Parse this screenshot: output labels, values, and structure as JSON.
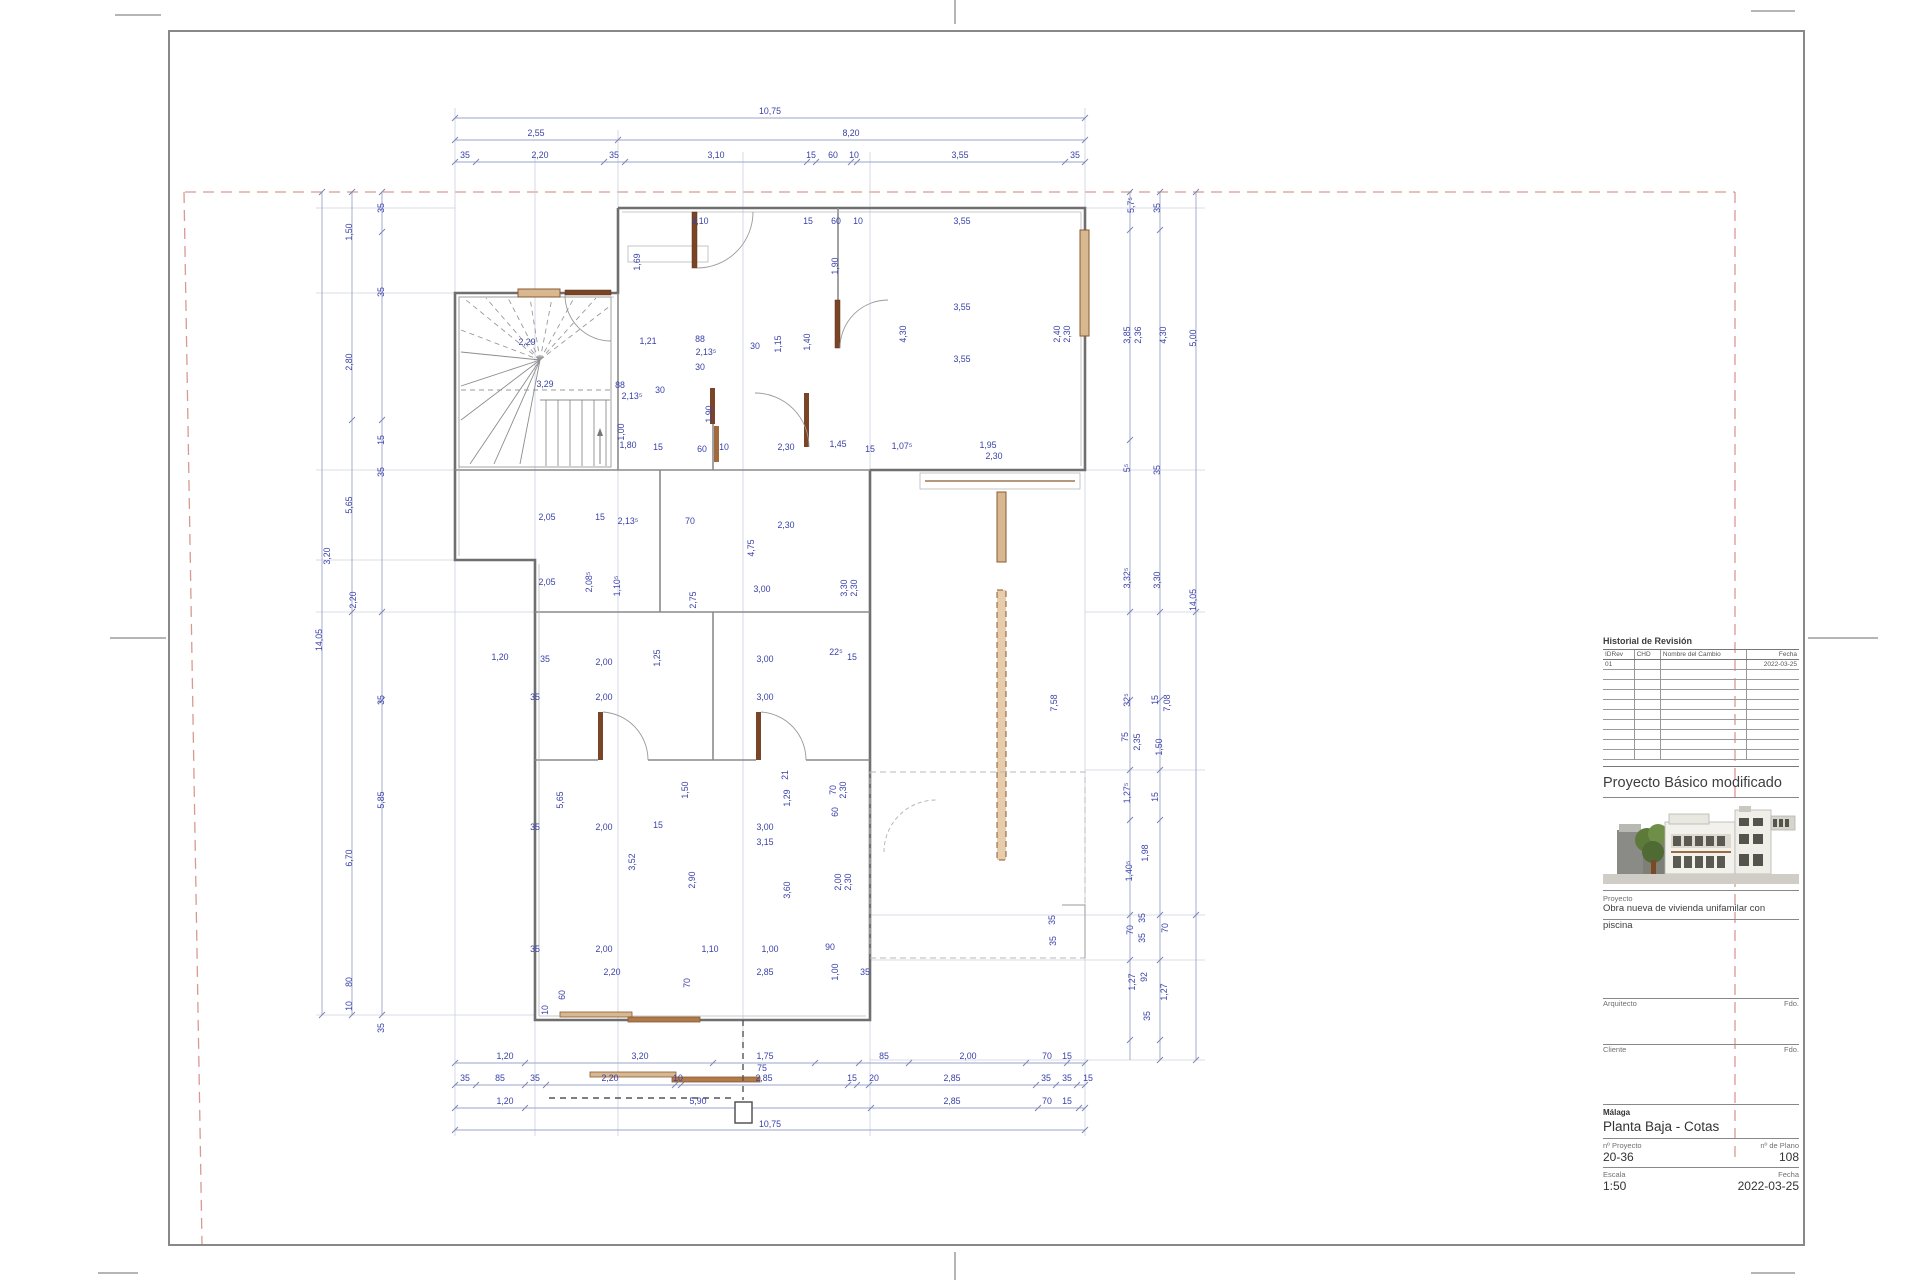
{
  "title_block": {
    "revision": {
      "title": "Historial de Revisión",
      "columns": [
        "IDRev",
        "CHD",
        "Nombre del Cambio",
        "Fecha"
      ],
      "rows": [
        [
          "01",
          "",
          "",
          "2022-03-25"
        ]
      ],
      "empty_row_count": 9
    },
    "project_title": "Proyecto Básico modificado",
    "proyecto_label": "Proyecto",
    "proyecto_line1": "Obra nueva de vivienda unifamilar con",
    "proyecto_line2": "piscina",
    "arquitecto_label": "Arquitecto",
    "cliente_label": "Cliente",
    "fdo_label": "Fdo.",
    "city": "Málaga",
    "sheet_name": "Planta Baja - Cotas",
    "num_proyecto_label": "nº Proyecto",
    "num_plano_label": "nº de Plano",
    "num_proyecto": "20-36",
    "num_plano": "108",
    "escala_label": "Escala",
    "fecha_label": "Fecha",
    "escala": "1:50",
    "fecha": "2022-03-25"
  },
  "colors": {
    "dim_text": "#3a41a8",
    "dim_line": "#9aa3c9",
    "wall": "#6f6f6f",
    "door_wood": "#8a5a32",
    "door_wood_fill": "#d8b890",
    "boundary_red": "#d89a90"
  },
  "drawing": {
    "dims": [
      {
        "x": 770,
        "y": 114,
        "t": "10,75"
      },
      {
        "x": 536,
        "y": 136,
        "t": "2,55"
      },
      {
        "x": 851,
        "y": 136,
        "t": "8,20"
      },
      {
        "x": 465,
        "y": 158,
        "t": "35"
      },
      {
        "x": 540,
        "y": 158,
        "t": "2,20"
      },
      {
        "x": 614,
        "y": 158,
        "t": "35"
      },
      {
        "x": 716,
        "y": 158,
        "t": "3,10"
      },
      {
        "x": 811,
        "y": 158,
        "t": "15"
      },
      {
        "x": 833,
        "y": 158,
        "t": "60"
      },
      {
        "x": 854,
        "y": 158,
        "t": "10"
      },
      {
        "x": 960,
        "y": 158,
        "t": "3,55"
      },
      {
        "x": 1075,
        "y": 158,
        "t": "35"
      },
      {
        "x": 505,
        "y": 1059,
        "t": "1,20"
      },
      {
        "x": 640,
        "y": 1059,
        "t": "3,20"
      },
      {
        "x": 765,
        "y": 1059,
        "t": "1,75"
      },
      {
        "x": 762,
        "y": 1071,
        "t": "75"
      },
      {
        "x": 884,
        "y": 1059,
        "t": "85"
      },
      {
        "x": 968,
        "y": 1059,
        "t": "2,00"
      },
      {
        "x": 1047,
        "y": 1059,
        "t": "70"
      },
      {
        "x": 1067,
        "y": 1059,
        "t": "15"
      },
      {
        "x": 465,
        "y": 1081,
        "t": "35"
      },
      {
        "x": 500,
        "y": 1081,
        "t": "85"
      },
      {
        "x": 535,
        "y": 1081,
        "t": "35"
      },
      {
        "x": 610,
        "y": 1081,
        "t": "2,20"
      },
      {
        "x": 678,
        "y": 1081,
        "t": "10"
      },
      {
        "x": 764,
        "y": 1081,
        "t": "2,85"
      },
      {
        "x": 852,
        "y": 1081,
        "t": "15"
      },
      {
        "x": 874,
        "y": 1081,
        "t": "20"
      },
      {
        "x": 952,
        "y": 1081,
        "t": "2,85"
      },
      {
        "x": 1046,
        "y": 1081,
        "t": "35"
      },
      {
        "x": 1067,
        "y": 1081,
        "t": "35"
      },
      {
        "x": 1088,
        "y": 1081,
        "t": "15"
      },
      {
        "x": 505,
        "y": 1104,
        "t": "1,20"
      },
      {
        "x": 698,
        "y": 1104,
        "t": "5,90"
      },
      {
        "x": 952,
        "y": 1104,
        "t": "2,85"
      },
      {
        "x": 1047,
        "y": 1104,
        "t": "70"
      },
      {
        "x": 1067,
        "y": 1104,
        "t": "15"
      },
      {
        "x": 770,
        "y": 1127,
        "t": "10,75"
      },
      {
        "x": 322,
        "y": 640,
        "t": "14,05",
        "r": "v"
      },
      {
        "x": 352,
        "y": 858,
        "t": "6,70",
        "r": "v"
      },
      {
        "x": 352,
        "y": 232,
        "t": "1,50",
        "r": "v"
      },
      {
        "x": 352,
        "y": 362,
        "t": "2,80",
        "r": "v"
      },
      {
        "x": 352,
        "y": 505,
        "t": "5,65",
        "r": "v"
      },
      {
        "x": 330,
        "y": 556,
        "t": "3,20",
        "r": "v"
      },
      {
        "x": 356,
        "y": 600,
        "t": "2,20",
        "r": "v"
      },
      {
        "x": 352,
        "y": 982,
        "t": "80",
        "r": "v"
      },
      {
        "x": 352,
        "y": 1006,
        "t": "10",
        "r": "v"
      },
      {
        "x": 384,
        "y": 208,
        "t": "35",
        "r": "v"
      },
      {
        "x": 384,
        "y": 292,
        "t": "35",
        "r": "v"
      },
      {
        "x": 384,
        "y": 440,
        "t": "15",
        "r": "v"
      },
      {
        "x": 384,
        "y": 472,
        "t": "35",
        "r": "v"
      },
      {
        "x": 384,
        "y": 700,
        "t": "35",
        "r": "v"
      },
      {
        "x": 384,
        "y": 800,
        "t": "5,85",
        "r": "v"
      },
      {
        "x": 384,
        "y": 1028,
        "t": "35",
        "r": "v"
      },
      {
        "x": 1134,
        "y": 205,
        "t": "5,7⁵",
        "r": "v"
      },
      {
        "x": 1160,
        "y": 208,
        "t": "35",
        "r": "v"
      },
      {
        "x": 1130,
        "y": 335,
        "t": "3,85",
        "r": "v"
      },
      {
        "x": 1141,
        "y": 335,
        "t": "2,36",
        "r": "v"
      },
      {
        "x": 1166,
        "y": 335,
        "t": "4,30",
        "r": "v"
      },
      {
        "x": 1196,
        "y": 338,
        "t": "5,00",
        "r": "v"
      },
      {
        "x": 1130,
        "y": 468,
        "t": "5⁵",
        "r": "v"
      },
      {
        "x": 1160,
        "y": 470,
        "t": "35",
        "r": "v"
      },
      {
        "x": 1130,
        "y": 578,
        "t": "3,32⁵",
        "r": "v"
      },
      {
        "x": 1160,
        "y": 580,
        "t": "3,30",
        "r": "v"
      },
      {
        "x": 1196,
        "y": 600,
        "t": "14,05",
        "r": "v"
      },
      {
        "x": 1130,
        "y": 700,
        "t": "32⁵",
        "r": "v"
      },
      {
        "x": 1158,
        "y": 700,
        "t": "15",
        "r": "v"
      },
      {
        "x": 1128,
        "y": 737,
        "t": "75",
        "r": "v"
      },
      {
        "x": 1140,
        "y": 742,
        "t": "2,35",
        "r": "v"
      },
      {
        "x": 1162,
        "y": 747,
        "t": "1,50",
        "r": "v"
      },
      {
        "x": 1130,
        "y": 793,
        "t": "1,27⁵",
        "r": "v"
      },
      {
        "x": 1158,
        "y": 797,
        "t": "15",
        "r": "v"
      },
      {
        "x": 1132,
        "y": 871,
        "t": "1,40⁵",
        "r": "v"
      },
      {
        "x": 1148,
        "y": 853,
        "t": "1,98",
        "r": "v"
      },
      {
        "x": 1133,
        "y": 930,
        "t": "70",
        "r": "v"
      },
      {
        "x": 1145,
        "y": 918,
        "t": "35",
        "r": "v"
      },
      {
        "x": 1145,
        "y": 938,
        "t": "35",
        "r": "v"
      },
      {
        "x": 1168,
        "y": 928,
        "t": "70",
        "r": "v"
      },
      {
        "x": 1135,
        "y": 982,
        "t": "1,27",
        "r": "v"
      },
      {
        "x": 1147,
        "y": 977,
        "t": "92",
        "r": "v"
      },
      {
        "x": 1167,
        "y": 992,
        "t": "1,27",
        "r": "v"
      },
      {
        "x": 1150,
        "y": 1016,
        "t": "35",
        "r": "v"
      },
      {
        "x": 1170,
        "y": 703,
        "t": "7,08",
        "r": "v"
      },
      {
        "x": 1057,
        "y": 703,
        "t": "7,58",
        "r": "v"
      },
      {
        "x": 1055,
        "y": 920,
        "t": "35",
        "r": "v"
      },
      {
        "x": 1056,
        "y": 941,
        "t": "35",
        "r": "v"
      },
      {
        "x": 700,
        "y": 224,
        "t": "3,10"
      },
      {
        "x": 808,
        "y": 224,
        "t": "15"
      },
      {
        "x": 836,
        "y": 224,
        "t": "60"
      },
      {
        "x": 858,
        "y": 224,
        "t": "10"
      },
      {
        "x": 962,
        "y": 224,
        "t": "3,55"
      },
      {
        "x": 640,
        "y": 262,
        "t": "1,69",
        "r": "v"
      },
      {
        "x": 838,
        "y": 266,
        "t": "1,90",
        "r": "v"
      },
      {
        "x": 962,
        "y": 310,
        "t": "3,55"
      },
      {
        "x": 906,
        "y": 334,
        "t": "4,30",
        "r": "v"
      },
      {
        "x": 1060,
        "y": 334,
        "t": "2,40",
        "r": "v"
      },
      {
        "x": 1070,
        "y": 334,
        "t": "2,30",
        "r": "v"
      },
      {
        "x": 962,
        "y": 362,
        "t": "3,55"
      },
      {
        "x": 648,
        "y": 344,
        "t": "1,21"
      },
      {
        "x": 700,
        "y": 342,
        "t": "88"
      },
      {
        "x": 706,
        "y": 355,
        "t": "2,13⁵"
      },
      {
        "x": 755,
        "y": 349,
        "t": "30"
      },
      {
        "x": 781,
        "y": 344,
        "t": "1,15",
        "r": "v"
      },
      {
        "x": 810,
        "y": 342,
        "t": "1,40",
        "r": "v"
      },
      {
        "x": 527,
        "y": 345,
        "t": "2,29"
      },
      {
        "x": 545,
        "y": 387,
        "t": "3,29"
      },
      {
        "x": 620,
        "y": 388,
        "t": "88"
      },
      {
        "x": 632,
        "y": 399,
        "t": "2,13⁵"
      },
      {
        "x": 660,
        "y": 393,
        "t": "30"
      },
      {
        "x": 700,
        "y": 370,
        "t": "30"
      },
      {
        "x": 628,
        "y": 448,
        "t": "1,80"
      },
      {
        "x": 658,
        "y": 450,
        "t": "15"
      },
      {
        "x": 702,
        "y": 452,
        "t": "60"
      },
      {
        "x": 724,
        "y": 450,
        "t": "10"
      },
      {
        "x": 786,
        "y": 450,
        "t": "2,30"
      },
      {
        "x": 838,
        "y": 447,
        "t": "1,45"
      },
      {
        "x": 870,
        "y": 452,
        "t": "15"
      },
      {
        "x": 902,
        "y": 449,
        "t": "1,07⁵"
      },
      {
        "x": 988,
        "y": 448,
        "t": "1,95"
      },
      {
        "x": 994,
        "y": 459,
        "t": "2,30"
      },
      {
        "x": 624,
        "y": 432,
        "t": "1,00",
        "r": "v"
      },
      {
        "x": 712,
        "y": 414,
        "t": "1,90",
        "r": "v"
      },
      {
        "x": 547,
        "y": 520,
        "t": "2,05"
      },
      {
        "x": 600,
        "y": 520,
        "t": "15"
      },
      {
        "x": 628,
        "y": 524,
        "t": "2,13⁵"
      },
      {
        "x": 690,
        "y": 524,
        "t": "70"
      },
      {
        "x": 786,
        "y": 528,
        "t": "2,30"
      },
      {
        "x": 754,
        "y": 548,
        "t": "4,75",
        "r": "v"
      },
      {
        "x": 847,
        "y": 588,
        "t": "3,30",
        "r": "v"
      },
      {
        "x": 857,
        "y": 588,
        "t": "2,30",
        "r": "v"
      },
      {
        "x": 547,
        "y": 585,
        "t": "2,05"
      },
      {
        "x": 592,
        "y": 582,
        "t": "2,08⁵",
        "r": "v"
      },
      {
        "x": 620,
        "y": 586,
        "t": "1,10⁵",
        "r": "v"
      },
      {
        "x": 696,
        "y": 600,
        "t": "2,75",
        "r": "v"
      },
      {
        "x": 762,
        "y": 592,
        "t": "3,00"
      },
      {
        "x": 500,
        "y": 660,
        "t": "1,20"
      },
      {
        "x": 545,
        "y": 662,
        "t": "35"
      },
      {
        "x": 604,
        "y": 665,
        "t": "2,00"
      },
      {
        "x": 660,
        "y": 658,
        "t": "1,25",
        "r": "v"
      },
      {
        "x": 765,
        "y": 662,
        "t": "3,00"
      },
      {
        "x": 836,
        "y": 655,
        "t": "22⁵"
      },
      {
        "x": 852,
        "y": 660,
        "t": "15"
      },
      {
        "x": 535,
        "y": 700,
        "t": "35"
      },
      {
        "x": 604,
        "y": 700,
        "t": "2,00"
      },
      {
        "x": 765,
        "y": 700,
        "t": "3,00"
      },
      {
        "x": 688,
        "y": 790,
        "t": "1,50",
        "r": "v"
      },
      {
        "x": 790,
        "y": 798,
        "t": "1,29",
        "r": "v"
      },
      {
        "x": 836,
        "y": 790,
        "t": "70",
        "r": "v"
      },
      {
        "x": 846,
        "y": 790,
        "t": "2,30",
        "r": "v"
      },
      {
        "x": 788,
        "y": 775,
        "t": "21",
        "r": "v"
      },
      {
        "x": 535,
        "y": 830,
        "t": "35"
      },
      {
        "x": 604,
        "y": 830,
        "t": "2,00"
      },
      {
        "x": 658,
        "y": 828,
        "t": "15"
      },
      {
        "x": 765,
        "y": 830,
        "t": "3,00"
      },
      {
        "x": 535,
        "y": 952,
        "t": "35"
      },
      {
        "x": 604,
        "y": 952,
        "t": "2,00"
      },
      {
        "x": 710,
        "y": 952,
        "t": "1,10"
      },
      {
        "x": 770,
        "y": 952,
        "t": "1,00"
      },
      {
        "x": 830,
        "y": 950,
        "t": "90"
      },
      {
        "x": 563,
        "y": 800,
        "t": "5,65",
        "r": "v"
      },
      {
        "x": 635,
        "y": 862,
        "t": "3,52",
        "r": "v"
      },
      {
        "x": 695,
        "y": 880,
        "t": "2,90",
        "r": "v"
      },
      {
        "x": 790,
        "y": 890,
        "t": "3,60",
        "r": "v"
      },
      {
        "x": 765,
        "y": 845,
        "t": "3,15"
      },
      {
        "x": 838,
        "y": 812,
        "t": "60",
        "r": "v"
      },
      {
        "x": 841,
        "y": 882,
        "t": "2,00",
        "r": "v"
      },
      {
        "x": 851,
        "y": 882,
        "t": "2,30",
        "r": "v"
      },
      {
        "x": 612,
        "y": 975,
        "t": "2,20"
      },
      {
        "x": 690,
        "y": 983,
        "t": "70",
        "r": "v"
      },
      {
        "x": 565,
        "y": 995,
        "t": "60",
        "r": "v"
      },
      {
        "x": 548,
        "y": 1010,
        "t": "10",
        "r": "v"
      },
      {
        "x": 765,
        "y": 975,
        "t": "2,85"
      },
      {
        "x": 838,
        "y": 972,
        "t": "1,00",
        "r": "v"
      },
      {
        "x": 865,
        "y": 975,
        "t": "35"
      }
    ],
    "tick_chains": [
      {
        "o": "h",
        "pos": 118,
        "ticks": [
          455,
          1085
        ]
      },
      {
        "o": "h",
        "pos": 140,
        "ticks": [
          455,
          618,
          1085
        ]
      },
      {
        "o": "h",
        "pos": 162,
        "ticks": [
          455,
          476,
          604,
          625,
          807,
          816,
          851,
          857,
          1065,
          1085
        ]
      },
      {
        "o": "h",
        "pos": 1063,
        "ticks": [
          455,
          525,
          713,
          815,
          859,
          909,
          1026,
          1067,
          1085
        ]
      },
      {
        "o": "h",
        "pos": 1085,
        "ticks": [
          455,
          476,
          525,
          546,
          675,
          681,
          848,
          857,
          869,
          1036,
          1056,
          1077,
          1085
        ]
      },
      {
        "o": "h",
        "pos": 1108,
        "ticks": [
          455,
          525,
          871,
          1038,
          1079,
          1085
        ]
      },
      {
        "o": "h",
        "pos": 1130,
        "ticks": [
          455,
          1085
        ]
      },
      {
        "o": "v",
        "pos": 322,
        "ticks": [
          192,
          1015
        ]
      },
      {
        "o": "v",
        "pos": 352,
        "ticks": [
          192,
          420,
          612,
          1015
        ]
      },
      {
        "o": "v",
        "pos": 382,
        "ticks": [
          192,
          232,
          420,
          612,
          700,
          1015
        ]
      },
      {
        "o": "v",
        "pos": 1130,
        "ticks": [
          192,
          230,
          440,
          612,
          700,
          770,
          820,
          915,
          960,
          1040
        ]
      },
      {
        "o": "v",
        "pos": 1160,
        "ticks": [
          192,
          230,
          612,
          700,
          770,
          820,
          915,
          960,
          1040,
          1060
        ]
      },
      {
        "o": "v",
        "pos": 1196,
        "ticks": [
          192,
          612,
          915,
          1060
        ]
      }
    ]
  }
}
